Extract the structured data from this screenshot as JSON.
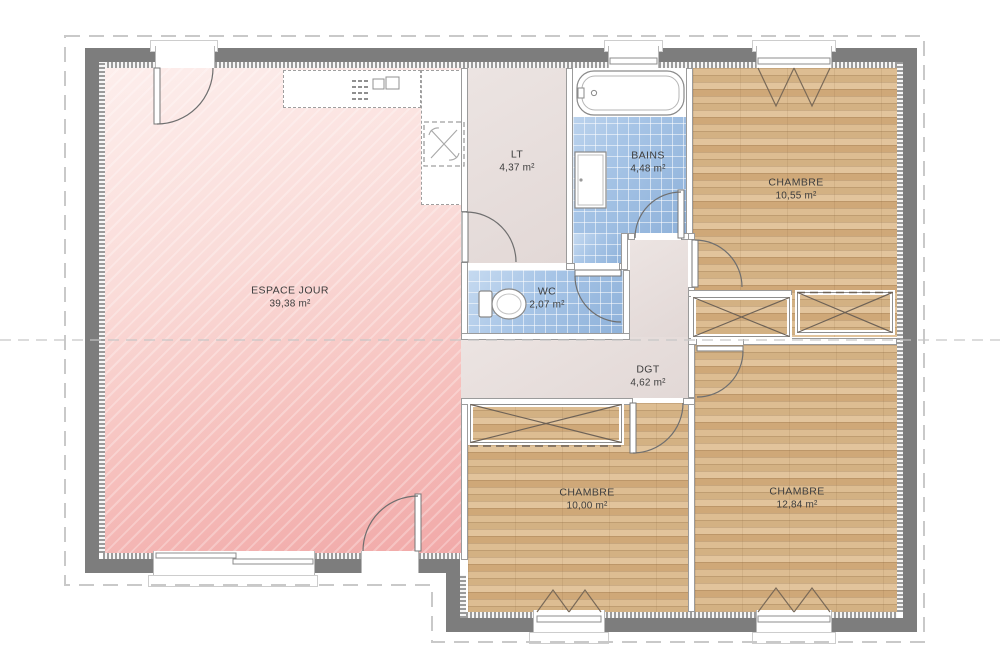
{
  "plan": {
    "rooms": [
      {
        "id": "espace-jour",
        "name": "ESPACE JOUR",
        "area": "39,38 m²"
      },
      {
        "id": "lt",
        "name": "LT",
        "area": "4,37 m²"
      },
      {
        "id": "bains",
        "name": "BAINS",
        "area": "4,48 m²"
      },
      {
        "id": "wc",
        "name": "WC",
        "area": "2,07 m²"
      },
      {
        "id": "dgt",
        "name": "DGT",
        "area": "4,62 m²"
      },
      {
        "id": "chambre-top-right",
        "name": "CHAMBRE",
        "area": "10,55 m²"
      },
      {
        "id": "chambre-bottom-middle",
        "name": "CHAMBRE",
        "area": "10,00 m²"
      },
      {
        "id": "chambre-bottom-right",
        "name": "CHAMBRE",
        "area": "12,84 m²"
      }
    ],
    "colors": {
      "floor_pink": "#f5b9b7",
      "floor_wood": "#d6b284",
      "floor_tile": "#a9c4e2",
      "floor_beige": "#e9e0de",
      "wall_gray": "#7d7d7d",
      "roof_outline_dash": "#c9c9c9"
    }
  }
}
